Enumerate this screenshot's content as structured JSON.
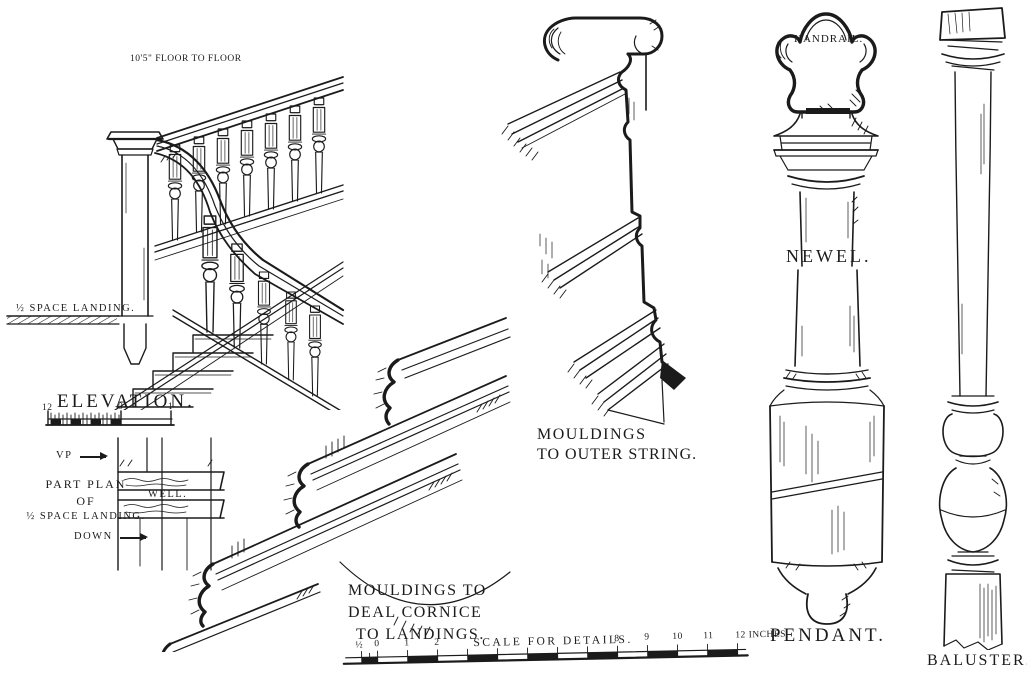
{
  "plate_title": "Staircase construction details plate",
  "ink": "#1b1b1b",
  "paper": "#ffffff",
  "elevation": {
    "dim_note": "10'5\" FLOOR TO FLOOR",
    "landing_label": "½ SPACE LANDING.",
    "title": "ELEVATION.",
    "scale_ticks": [
      "12",
      "0",
      "1"
    ]
  },
  "plan": {
    "vp_label": "VP",
    "title_line1": "PART PLAN",
    "title_line2": "OF",
    "title_line3": "½ SPACE LANDING.",
    "well_label": "WELL.",
    "down_label": "DOWN"
  },
  "cornice": {
    "label_line1": "MOULDINGS TO",
    "label_line2": "DEAL CORNICE",
    "label_line3": "TO LANDINGS."
  },
  "outer_string": {
    "label_line1": "MOULDINGS",
    "label_line2": "TO OUTER STRING."
  },
  "handrail": {
    "label": "HANDRAIL."
  },
  "newel": {
    "label": "NEWEL."
  },
  "pendant": {
    "label": "PENDANT."
  },
  "baluster": {
    "label": "BALUSTER."
  },
  "detail_scale": {
    "title": "SCALE FOR DETAILS.",
    "left_ticks": [
      "½",
      "0",
      "1",
      "2"
    ],
    "right_ticks": [
      "8",
      "9",
      "10",
      "11"
    ],
    "end_label": "12 INCHES."
  }
}
